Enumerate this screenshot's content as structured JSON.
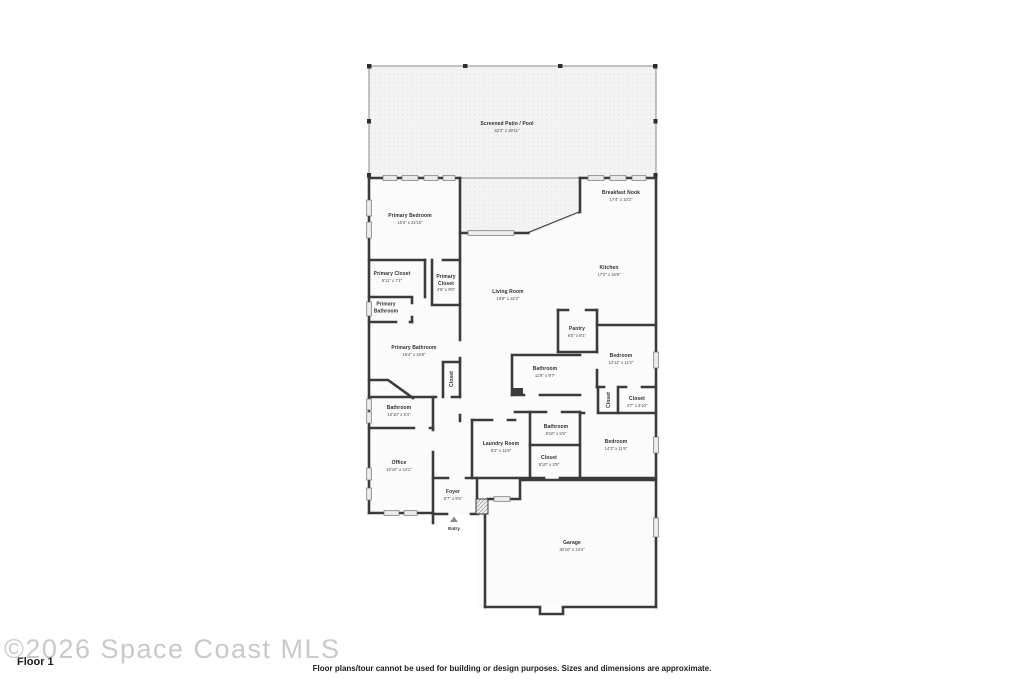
{
  "watermark": {
    "text": "©2026 Space Coast MLS"
  },
  "floor_label": "Floor 1",
  "disclaimer": "Floor plans/tour cannot be used for building or design purposes. Sizes and dimensions are approximate.",
  "entry_marker": {
    "label": "Entry",
    "icon": "triangle-up-icon"
  },
  "colors": {
    "wall": "#3b3b3b",
    "room_fill": "#fbfbfb",
    "patio_fill": "#f3f3f3",
    "window_fill": "#ececec",
    "label_text": "#2f2f2f",
    "watermark_text": "#c9c9c9"
  },
  "rooms": [
    {
      "id": "screened-patio",
      "name": "Screened Patio / Pool",
      "dims": "52'2\" x 29'11\""
    },
    {
      "id": "breakfast-nook",
      "name": "Breakfast Nook",
      "dims": "17'4\" x 10'2\""
    },
    {
      "id": "primary-bedroom",
      "name": "Primary Bedroom",
      "dims": "16'4\" x 22'10\""
    },
    {
      "id": "primary-closet-left",
      "name": "Primary Closet",
      "dims": "6'11\" x 7'1\""
    },
    {
      "id": "primary-closet-right",
      "name": "Primary Closet",
      "dims": "4'5\" x 9'6\""
    },
    {
      "id": "primary-bathroom-toilet",
      "name": "Primary Bathroom",
      "dims": ""
    },
    {
      "id": "kitchen",
      "name": "Kitchen",
      "dims": "17'2\" x 16'8\""
    },
    {
      "id": "living-room",
      "name": "Living Room",
      "dims": "18'9\" x 22'2\""
    },
    {
      "id": "pantry",
      "name": "Pantry",
      "dims": "6'5\" x 8'1\""
    },
    {
      "id": "primary-bathroom",
      "name": "Primary Bathroom",
      "dims": "16'4\" x 16'6\""
    },
    {
      "id": "bedroom-middle",
      "name": "Bedroom",
      "dims": "12'11\" x 11'2\""
    },
    {
      "id": "bathroom-middle",
      "name": "Bathroom",
      "dims": "11'8\" x 9'7\""
    },
    {
      "id": "closet-primary-vertical",
      "name": "Closet",
      "dims": ""
    },
    {
      "id": "closet-hall-vertical",
      "name": "Closet",
      "dims": ""
    },
    {
      "id": "closet-bedroom-right",
      "name": "Closet",
      "dims": "4'7\" x 3'10\""
    },
    {
      "id": "bathroom-left",
      "name": "Bathroom",
      "dims": "10'10\" x 5'4\""
    },
    {
      "id": "bathroom-center-small",
      "name": "Bathroom",
      "dims": "8'10\" x 5'5\""
    },
    {
      "id": "laundry-room",
      "name": "Laundry Room",
      "dims": "8'2\" x 11'6\""
    },
    {
      "id": "bedroom-right",
      "name": "Bedroom",
      "dims": "14'3\" x 11'6\""
    },
    {
      "id": "closet-center",
      "name": "Closet",
      "dims": "8'10\" x 3'9\""
    },
    {
      "id": "office",
      "name": "Office",
      "dims": "10'10\" x 14'1\""
    },
    {
      "id": "foyer",
      "name": "Foyer",
      "dims": "8'7\" x 9'5\""
    },
    {
      "id": "garage",
      "name": "Garage",
      "dims": "30'10\" x 24'4\""
    }
  ]
}
